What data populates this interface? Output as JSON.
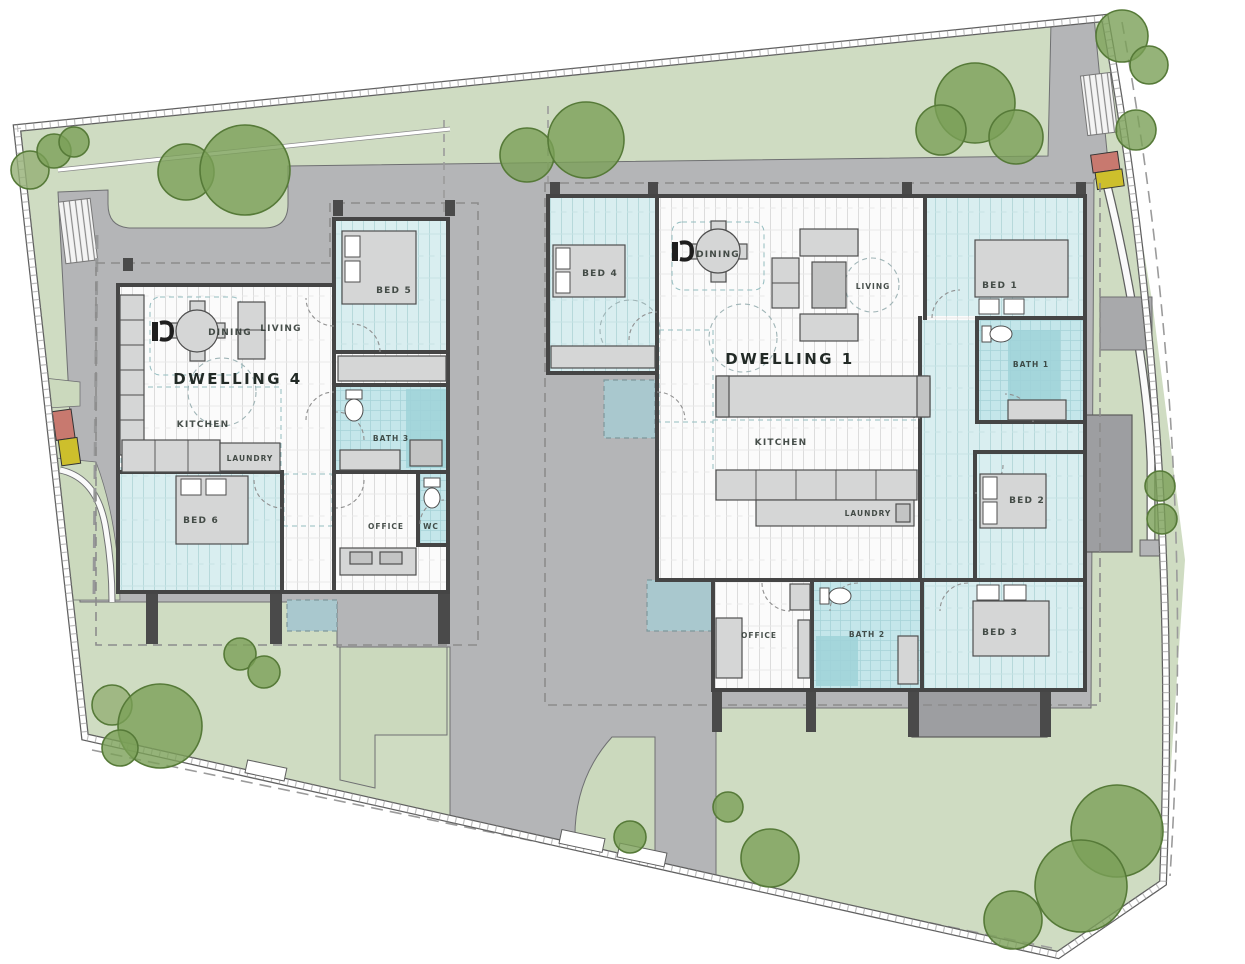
{
  "plan": {
    "dwelling4": {
      "title": "DWELLING 4",
      "rooms": {
        "living": "LIVING",
        "dining": "DINING",
        "kitchen": "KITCHEN",
        "laundry": "LAUNDRY",
        "bed5": "BED 5",
        "bed6": "BED 6",
        "bath3": "BATH 3",
        "office": "OFFICE",
        "wc": "WC"
      }
    },
    "dwelling1": {
      "title": "DWELLING 1",
      "rooms": {
        "bed4": "BED 4",
        "dining": "DINING",
        "living": "LIVING",
        "kitchen": "KITCHEN",
        "laundry": "LAUNDRY",
        "bed1": "BED 1",
        "bath1": "BATH 1",
        "bed2": "BED 2",
        "bed3": "BED 3",
        "bath2": "BATH 2",
        "office": "OFFICE"
      }
    }
  },
  "colors": {
    "site_green": "#cfdcc2",
    "garden_green": "#cbd9bd",
    "paving_gray": "#b4b5b7",
    "patio_gray": "#9d9ea1",
    "wall_gray": "#454545",
    "floor_white": "#fbfbfb",
    "carpet_cyan": "#d9eef0",
    "bath_cyan": "#c4e6ea",
    "entry_mat_teal": "#a9c8ce",
    "tree_green": "#7ba057",
    "marker_red": "#c8796f",
    "marker_yellow": "#cdbf2c",
    "label_ink": "#2f3833"
  }
}
